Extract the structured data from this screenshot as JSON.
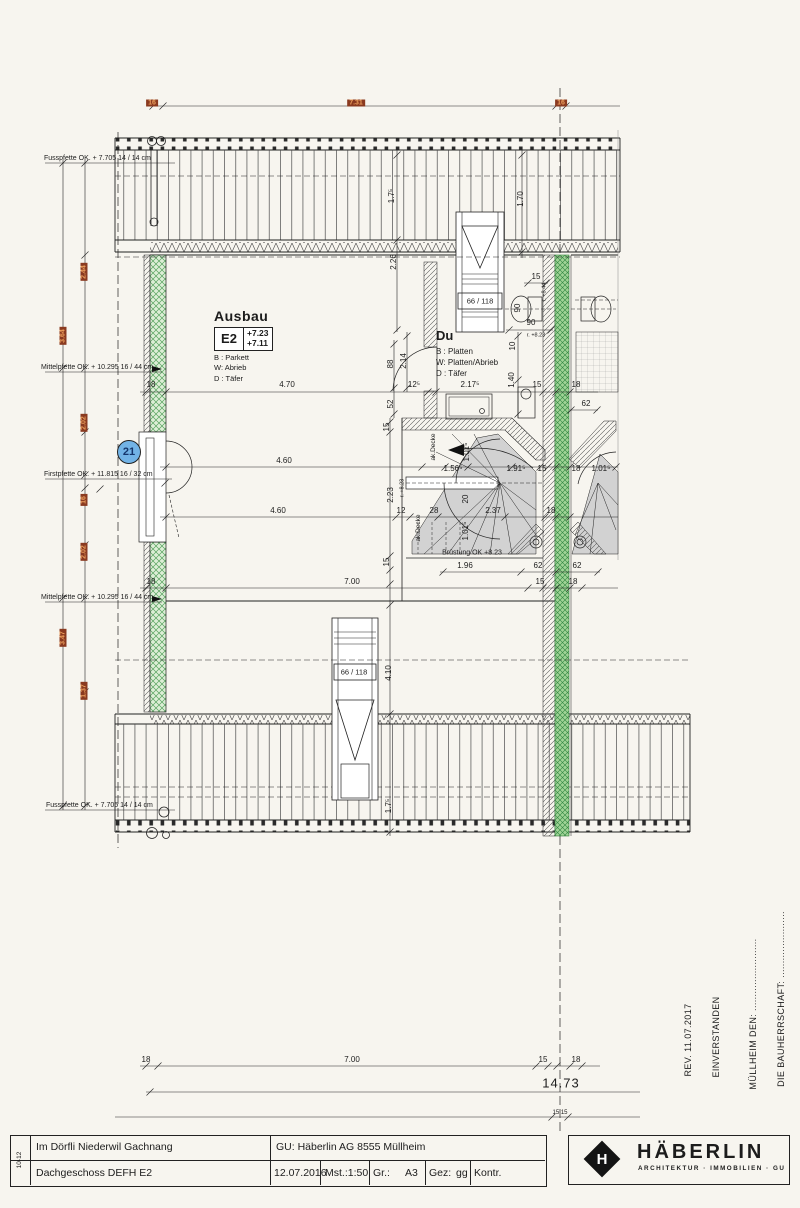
{
  "top_dims": {
    "left": "16",
    "span": "7.31",
    "right": "16"
  },
  "pfetten": [
    "Fusspfette OK. + 7.705 14 / 14 cm",
    "Mittelpfette OK. + 10.295 16 / 44 cm",
    "Firstpfette OK. + 11.815 16 / 32 cm",
    "Mittelpfette OK. + 10.295 16 / 44 cm",
    "Fusspfette OK. + 7.705 14 / 14 cm"
  ],
  "red_dims": [
    "2.44",
    "3.64",
    "2.02",
    "16",
    "2.02",
    "3.47",
    "1.37"
  ],
  "marker": {
    "value": "21"
  },
  "room": {
    "title": "Ausbau",
    "unit": "E2",
    "level_top": "+7.23",
    "level_bottom": "+7.11",
    "floor": "B : Parkett",
    "wall": "W: Abrieb",
    "ceiling": "D : Täfer"
  },
  "bath": {
    "title": "Du",
    "floor": "B : Platten",
    "wall": "W: Platten/Abrieb",
    "ceiling": "D : Täfer"
  },
  "dims": {
    "w470": "4.70",
    "w460": "4.60",
    "w700": "7.00",
    "d18": "18",
    "d15": "15",
    "d62": "62",
    "sky": "66 / 118",
    "v175": "1.7⁵",
    "v170": "1.70",
    "v226": "2.26",
    "v214": "2.14",
    "v88": "88",
    "v52": "52",
    "d125": "12⁵",
    "d2175": "2.17⁵",
    "d90": "90",
    "v10": "10",
    "v140": "1.40",
    "r823": "r. +8.23",
    "r844": "r. +8.44",
    "akdecke": "ak.Decke",
    "d156": "1.56⁵",
    "v101": "1.01⁵",
    "d191": "1.91⁵",
    "v223": "2.23",
    "d12": "12",
    "d28": "28",
    "v20": "20",
    "d237": "2.37",
    "bruestung": "Brüstung OK +8.23",
    "d196": "1.96",
    "v410": "4.10"
  },
  "bottom_dims": {
    "a": "18",
    "b": "7.00",
    "c": "15",
    "d": "18",
    "total": "14.73",
    "half": "15 15"
  },
  "notes": {
    "rev": "REV. 11.07.2017",
    "agreed": "EINVERSTANDEN",
    "place": "MÜLLHEIM DEN: .........................",
    "owner": "DIE BAUHERRSCHAFT: ......................."
  },
  "title_block": {
    "index": "10-12",
    "project": "Im Dörfli Niederwil Gachnang",
    "sheet": "Dachgeschoss DEFH E2",
    "gu": "GU:  Häberlin AG   8555 Müllheim",
    "date": "12.07.2016",
    "scale": "Mst.:1:50",
    "size_label": "Gr.:",
    "size_value": "A3",
    "drawn_label": "Gez:",
    "drawn_value": "gg",
    "checked_label": "Kontr."
  },
  "logo": {
    "monogram": "H",
    "name": "HÄBERLIN",
    "tagline": "ARCHITEKTUR · IMMOBILIEN · GU"
  }
}
